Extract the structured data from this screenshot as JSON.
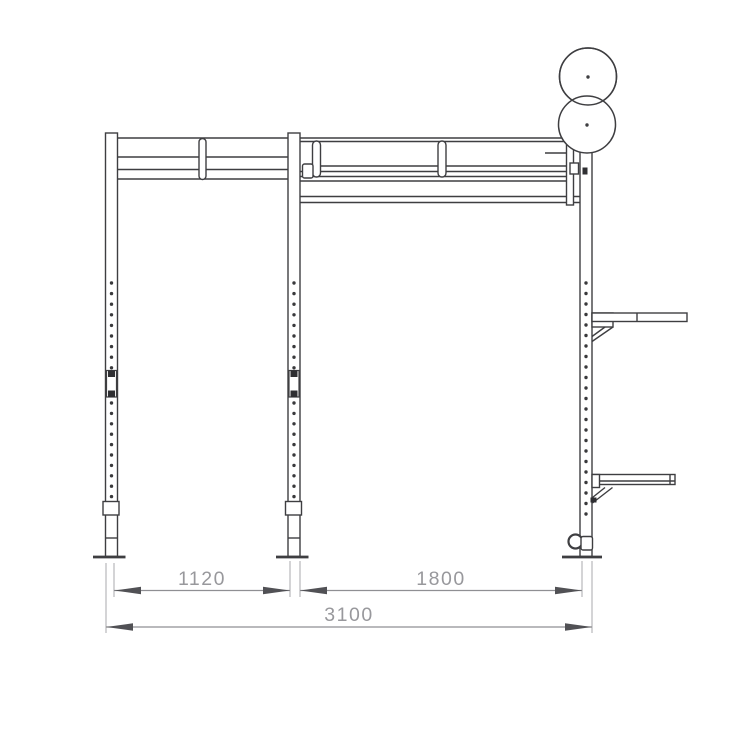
{
  "page": {
    "background": "#ffffff"
  },
  "drawing": {
    "type": "technical-elevation",
    "subject": "wall-mounted gym rig with double ball targets, plate shelves and overall width dimensions",
    "colors": {
      "structure": "#3e3e41",
      "dimension_line": "#8f8f93",
      "extension_line": "#aaaaad",
      "dimension_text": "#98989c",
      "arrowhead": "#515155",
      "background": "#ffffff"
    },
    "dimensions": [
      {
        "id": "left-bay-width",
        "label": "1120"
      },
      {
        "id": "right-bay-width",
        "label": "1800"
      },
      {
        "id": "overall-width",
        "label": "3100"
      }
    ]
  }
}
